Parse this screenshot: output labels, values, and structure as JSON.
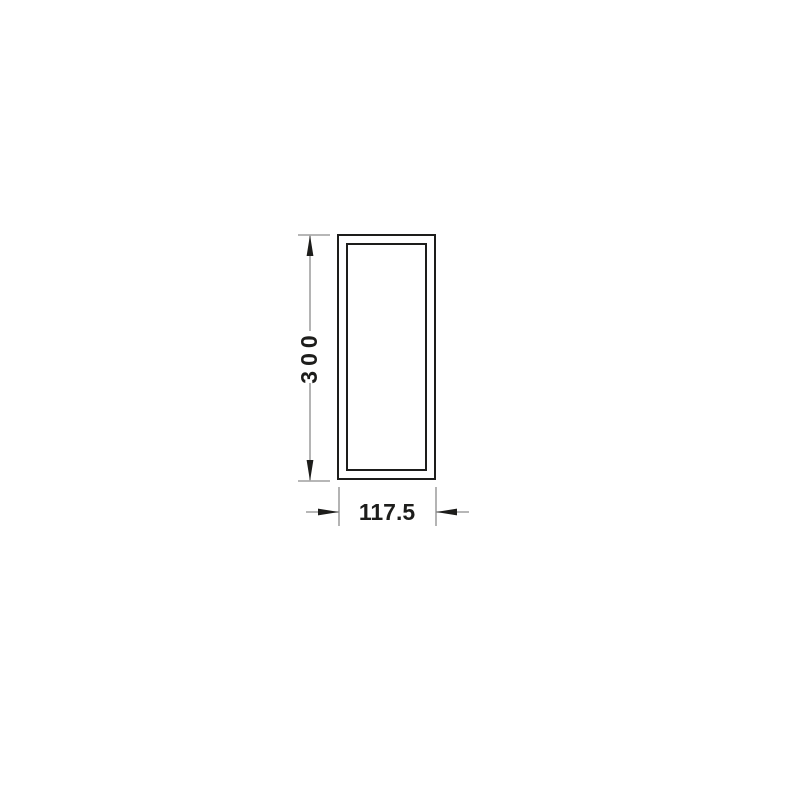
{
  "diagram": {
    "height_dimension_label": "300",
    "width_dimension_label": "117.5",
    "colors": {
      "outline": "#1d1d1b",
      "dimension_line": "#8c8c8c",
      "label_text": "#1d1d1b",
      "background": "#ffffff"
    }
  }
}
